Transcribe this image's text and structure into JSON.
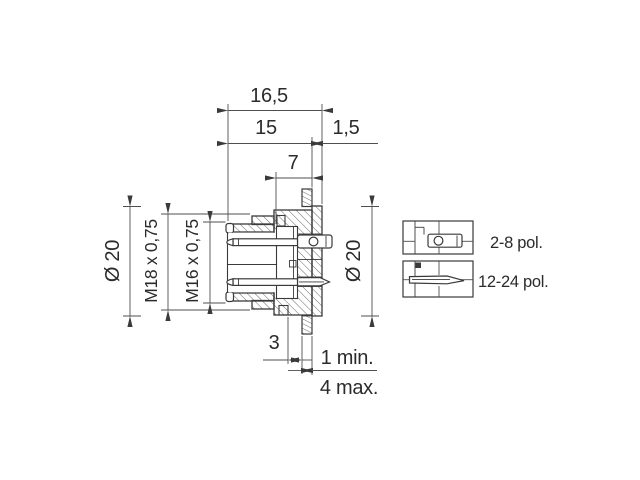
{
  "colors": {
    "line": "#3a3a3a",
    "dim_line": "#4f4f4f",
    "background": "#ffffff"
  },
  "drawing": {
    "dim_total_length": "16,5",
    "dim_front_length": "15",
    "dim_flange_thickness": "1,5",
    "dim_insert_depth": "7",
    "dia_left": "Ø 20",
    "thread_outer": "M18 x 0,75",
    "thread_inner": "M16 x 0,75",
    "dia_right": "Ø 20",
    "dim_key": "3",
    "panel_thickness_min": "1 min.",
    "panel_thickness_max": "4 max."
  },
  "legend": {
    "items": [
      {
        "icon": "round-solder-contact-icon",
        "label": "2-8 pol."
      },
      {
        "icon": "flat-solder-contact-icon",
        "label": "12-24 pol."
      }
    ]
  }
}
